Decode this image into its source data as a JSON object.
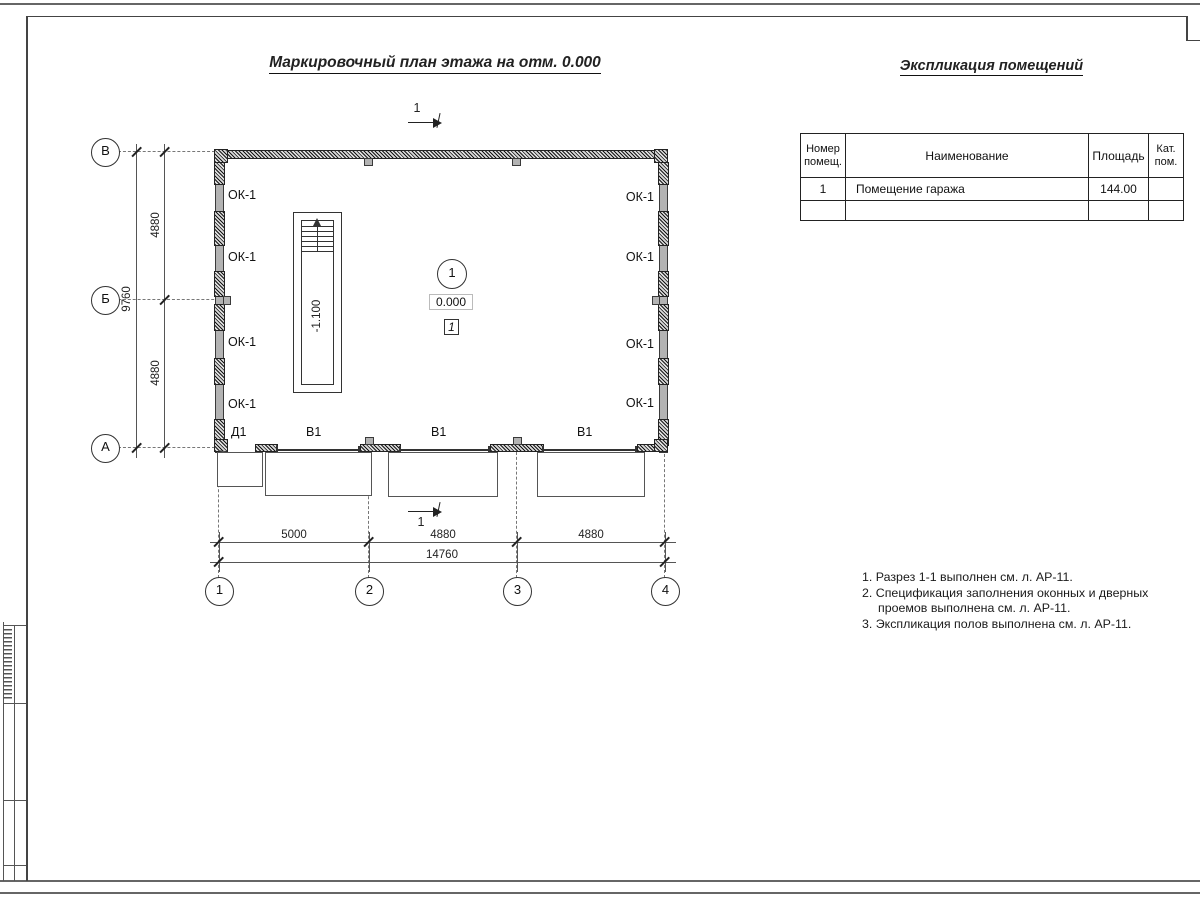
{
  "colors": {
    "line": "#333333",
    "wall_fill": "#b3b3b3"
  },
  "drawing": {
    "title": "Маркировочный план этажа на отм. 0.000",
    "section_mark_top": "1",
    "section_mark_bottom": "1",
    "room_marker": "1",
    "level_mark": "0.000",
    "floor_mark": "1",
    "stair_level": "-1.100",
    "labels": {
      "door": "Д1",
      "gates": [
        "В1",
        "В1",
        "В1"
      ],
      "windows_left": [
        "ОК-1",
        "ОК-1",
        "ОК-1",
        "ОК-1"
      ],
      "windows_right": [
        "ОК-1",
        "ОК-1",
        "ОК-1",
        "ОК-1"
      ]
    },
    "axes": {
      "rows": [
        "В",
        "Б",
        "А"
      ],
      "cols": [
        "1",
        "2",
        "3",
        "4"
      ]
    },
    "dims": {
      "left_spans": [
        "4880",
        "4880"
      ],
      "left_total": "9760",
      "bottom_spans": [
        "5000",
        "4880",
        "4880"
      ],
      "bottom_total": "14760"
    }
  },
  "table": {
    "title": "Экспликация помещений",
    "columns": [
      "Номер помещ.",
      "Наименование",
      "Площадь",
      "Кат. пом."
    ],
    "rows": [
      {
        "number": "1",
        "name": "Помещение гаража",
        "area": "144.00",
        "category": ""
      },
      {
        "number": "",
        "name": "",
        "area": "",
        "category": ""
      }
    ]
  },
  "notes": [
    "1. Разрез 1-1 выполнен см. л. АР-11.",
    "2. Спецификация заполнения оконных и дверных проемов выполнена см. л. АР-11.",
    "3. Экспликация полов выполнена см. л. АР-11."
  ]
}
